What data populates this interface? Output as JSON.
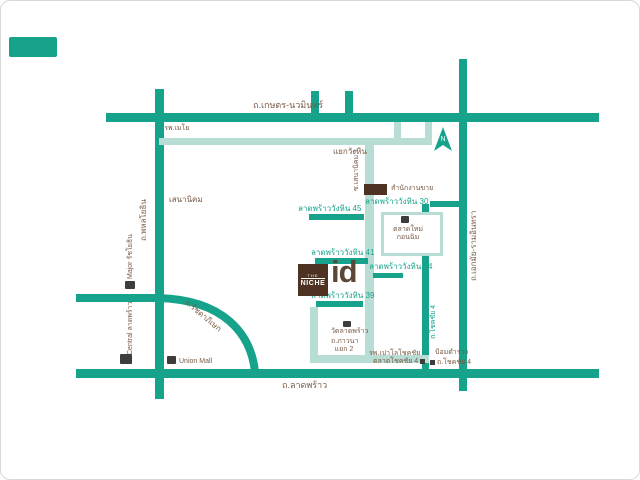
{
  "colors": {
    "road_primary": "#16a28b",
    "road_secondary": "#b7ddd5",
    "text_brown": "#7a5a45",
    "text_teal": "#17a48d",
    "brand_brown": "#4e3322"
  },
  "map": {
    "roads": {
      "kaset_nawamin": {
        "label": "ถ.เกษตร-นวมินทร์"
      },
      "phahonyothin": {
        "label": "ถ.พหลโยธิน"
      },
      "ekamai_ramintra": {
        "label": "ถ.เอกมัย-รามอินทรา"
      },
      "ladprao": {
        "label": "ถ.ลาดพร้าว"
      },
      "ratchadaphisek": {
        "label": "ถ.รัชดาภิเษก"
      },
      "chokchai4": {
        "label": "ถ.โชคชัย 4"
      },
      "sena_nikhom1": {
        "label": "ซ.เสนานิคม 1"
      }
    },
    "junctions": {
      "wanghin": "แยกวังหิน",
      "sena_nikhom": "เสนานิคม"
    },
    "sois": [
      {
        "name": "ลาดพร้าววังหิน 45"
      },
      {
        "name": "ลาดพร้าววังหิน 41"
      },
      {
        "name": "ลาดพร้าววังหิน 39"
      },
      {
        "name": "ลาดพร้าววังหิน 30"
      },
      {
        "name": "ลาดพร้าววังหิน 24"
      }
    ],
    "landmarks": {
      "mayo_hospital": "รพ.เมโย",
      "sales_office": "สำนักงานขาย",
      "new_market_line1": "ตลาดใหม่",
      "new_market_line2": "กอนฉิม",
      "major_ratchayothin": "Major รัชโยธิน",
      "central_ladprao": "Central ลาดพร้าว",
      "union_mall": "Union Mall",
      "wat_ladprao": "วัดลาดพร้าว",
      "phawana_line1": "ถ.ภาวนา",
      "phawana_line2": "แยก 2",
      "paolo_hospital": "รพ.เปาโลโชคชัย",
      "chokchai4_market": "ตลาดโชคชัย 4",
      "police_box": "ป้อมตำรวจ",
      "chokchai4_road_small": "ถ.โชคชัย 4"
    },
    "project": {
      "logo_top": "THE",
      "logo_name": "NICHE",
      "logo_id": "id"
    },
    "compass": {
      "label": "N"
    }
  }
}
